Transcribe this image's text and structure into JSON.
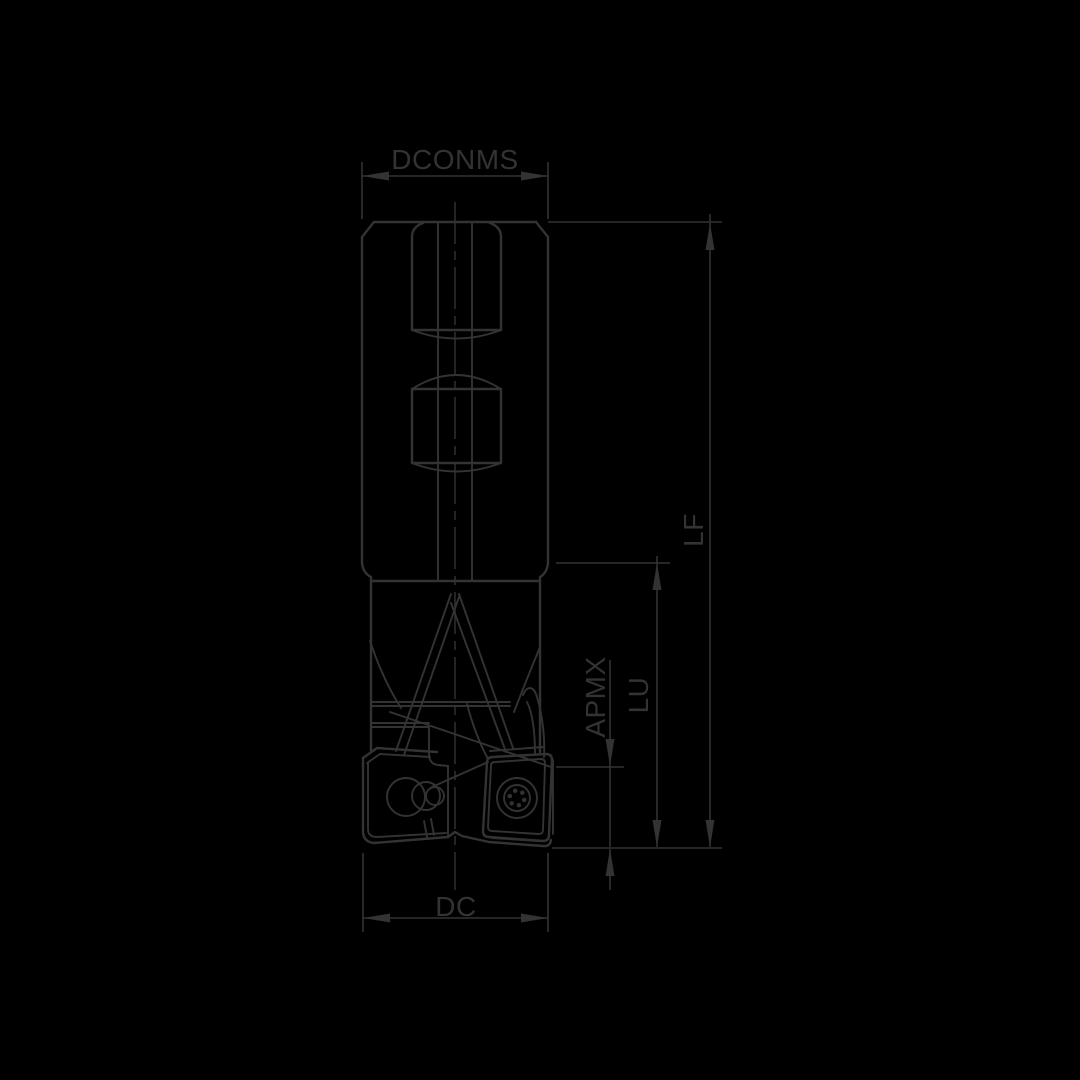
{
  "canvas": {
    "width": 1080,
    "height": 1080,
    "colors": {
      "background": "#000000",
      "line": "#333333"
    }
  },
  "drawing": {
    "labels": {
      "shank_diameter": "DCONMS",
      "functional_length": "LF",
      "max_cutting_depth": "APMX",
      "usable_length": "LU",
      "cutting_diameter": "DC"
    }
  }
}
